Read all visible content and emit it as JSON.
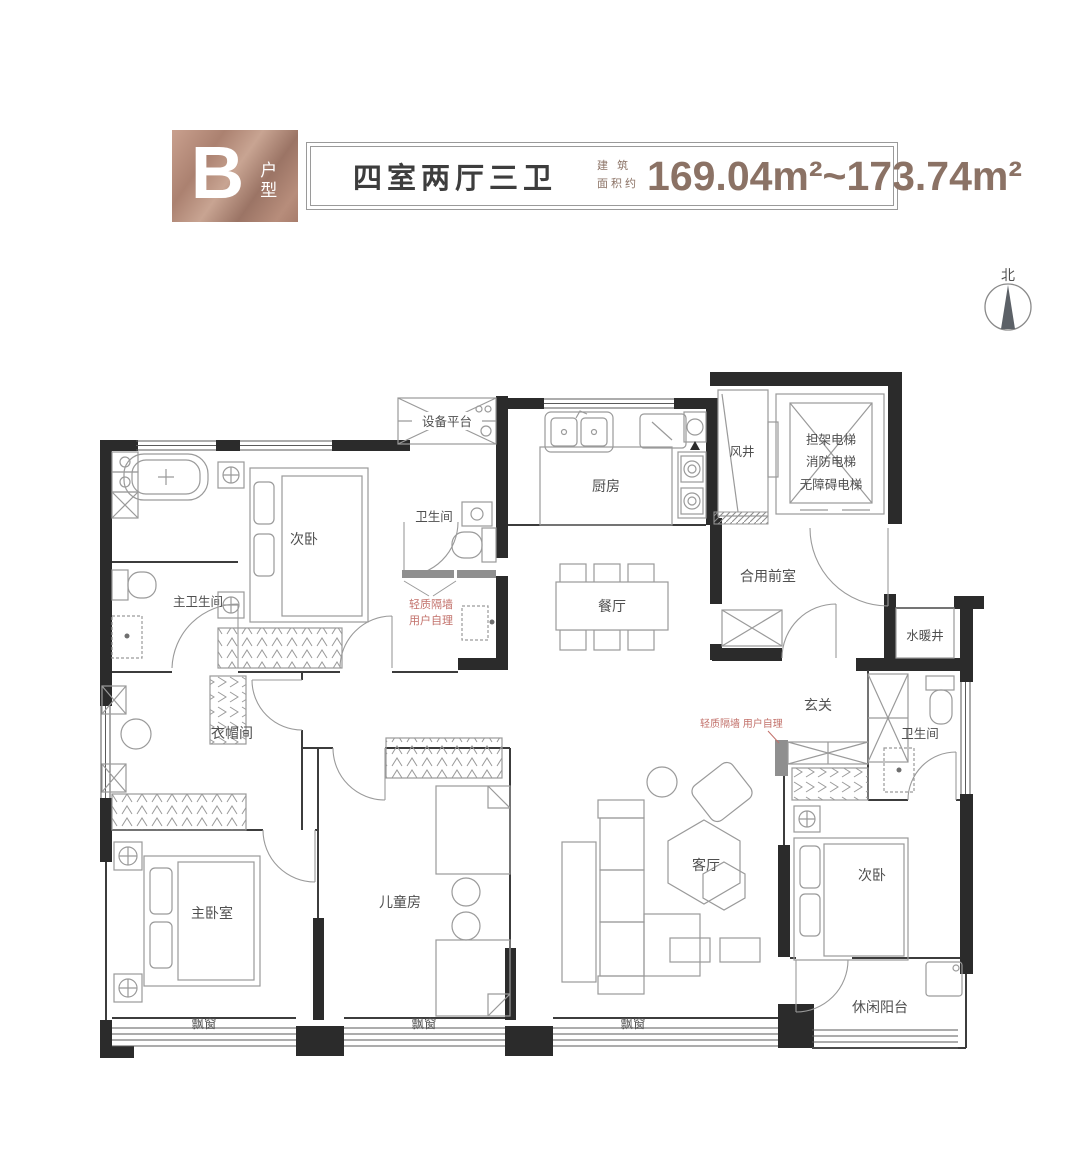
{
  "header": {
    "unit_letter": "B",
    "unit_suffix": "户型",
    "layout": "四室两厅三卫",
    "area_label_top": "建 筑",
    "area_label_bottom": "面积约",
    "area_value": "169.04m²~173.74m²",
    "accent_color": "#8b7265"
  },
  "compass": {
    "north": "北"
  },
  "plan": {
    "labels": {
      "equipment_platform": "设备平台",
      "kitchen": "厨房",
      "wind_shaft": "风井",
      "elevator_line1": "担架电梯",
      "elevator_line2": "消防电梯",
      "elevator_line3": "无障碍电梯",
      "shared_front_room": "合用前室",
      "plumbing_shaft": "水暖井",
      "bathroom_top": "卫生间",
      "bedroom2_top": "次卧",
      "master_bathroom": "主卫生间",
      "dining_room": "餐厅",
      "entry": "玄关",
      "cloakroom": "衣帽间",
      "master_bedroom": "主卧室",
      "children_room": "儿童房",
      "living_room": "客厅",
      "bedroom2_right": "次卧",
      "bathroom_right": "卫生间",
      "leisure_balcony": "休闲阳台",
      "bay_window": "飘窗"
    },
    "notes": {
      "partition_line1": "轻质隔墙",
      "partition_line2": "用户自理",
      "partition_inline": "轻质隔墙  用户自理"
    },
    "colors": {
      "wall": "#2b2b2b",
      "furniture_line": "#9a9a9a",
      "label_text": "#4f4f4f",
      "note_text": "#c2706a"
    }
  }
}
